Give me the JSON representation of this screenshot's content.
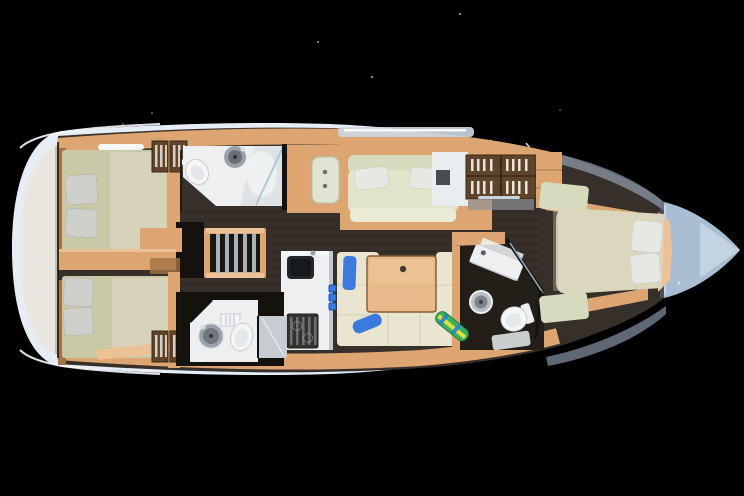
{
  "scene": {
    "label": "Sailing yacht interior layout, top-down cutaway rendering on black background",
    "view": "top-down",
    "background": "#000000"
  },
  "colors": {
    "hull": "#e6edf4",
    "hullShadow": "#c2d0e0",
    "bowDeck": "#a9bdd3",
    "bowDeckHi": "#cbd8e6",
    "sternPlatform": "#e9e7e0",
    "wood": "#dca572",
    "woodLight": "#ecc197",
    "woodDark": "#a27343",
    "lockerBrown": "#5f432a",
    "floor": "#37302a",
    "floorDark": "#262018",
    "mattressAft": "#c9c8a7",
    "mattressAftLight": "#d8d5bd",
    "mattressFwd": "#dbd7bf",
    "settee": "#d8dabd",
    "setteeHi": "#e2e4ca",
    "cushionCream": "#eae5d0",
    "pillowGrey": "#cfd0cb",
    "pillowWhite": "#e7e7e3",
    "fixtureWhite": "#edeff1",
    "fixtureGrey": "#9aa1a8",
    "showerGrey": "#c7ccd2",
    "glass": "#a8c3d4",
    "wallDark": "#101214",
    "blue": "#3c7ade",
    "table": "#e8ba8a",
    "boardGreen": "#3cb05e",
    "boardBlue": "#2e7fd6",
    "boardYellow": "#dfe13e"
  },
  "regions": [
    "stern-platform",
    "aft-cabin-port",
    "aft-cabin-starboard",
    "aft-head-port",
    "aft-head-starboard",
    "companionway-stairs",
    "saloon-settee",
    "storage-lockers",
    "galley",
    "dinette",
    "forward-head",
    "forward-cabin",
    "bow-deck"
  ],
  "furniture": {
    "double_berths": 3,
    "heads_bathrooms": 3,
    "aft_cabin_pillows_each": 2,
    "forward_cabin_pillows": 2,
    "settee_pillows": 2,
    "dinette_blue_cushions": 2,
    "companionway_steps": 5,
    "saloon_tables": 1,
    "galley_blue_switches": 3
  }
}
